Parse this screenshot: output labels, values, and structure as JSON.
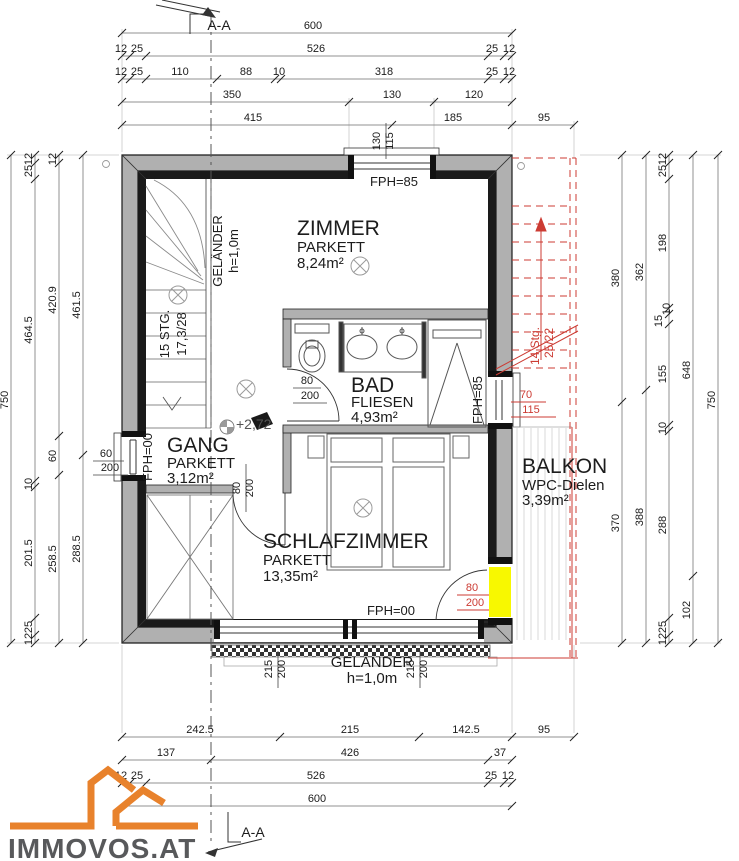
{
  "section": {
    "label": "A-A"
  },
  "logo": {
    "brand": "IMMOVOS.AT"
  },
  "colors": {
    "wall_gray": "#b0b0b0",
    "line_black": "#1a1a1a",
    "red": "#cc3b33",
    "yellow": "#f8f800",
    "logo_orange": "#e8822c",
    "logo_text": "#58595b"
  },
  "rooms": {
    "zimmer": {
      "name": "ZIMMER",
      "floor": "PARKETT",
      "area": "8,24m²"
    },
    "bad": {
      "name": "BAD",
      "floor": "FLIESEN",
      "area": "4,93m²"
    },
    "gang": {
      "name": "GANG",
      "floor": "PARKETT",
      "area": "3,12m²"
    },
    "schlafzimmer": {
      "name": "SCHLAFZIMMER",
      "floor": "PARKETT",
      "area": "13,35m²"
    },
    "balkon": {
      "name": "BALKON",
      "floor": "WPC-Dielen",
      "area": "3,39m²"
    }
  },
  "labels": {
    "fph85": "FPH=85",
    "fph00": "FPH=00",
    "gelaender_line1": "GELÄNDER",
    "gelaender_line2": "h=1,0m",
    "stairs_line1": "15 STG.",
    "stairs_line2": "17,3/28",
    "red_stairs_line1": "14 Stg.",
    "red_stairs_line2": "25/22",
    "level": "+2,72",
    "win_top_w": "130",
    "win_top_h": "115",
    "win_left_w": "60",
    "win_left_h": "200",
    "win_right_w": "70",
    "win_right_h": "115",
    "door_w": "80",
    "door_h": "200",
    "win_bottom_w": "215",
    "win_bottom_h": "200"
  },
  "dims": {
    "top_row1": [
      "600"
    ],
    "top_row2": [
      "12",
      "25",
      "526",
      "25",
      "12"
    ],
    "top_row3": [
      "12",
      "25",
      "110",
      "88",
      "10",
      "318",
      "25",
      "12"
    ],
    "top_row4": [
      "350",
      "130",
      "120"
    ],
    "top_row5": [
      "415",
      "185",
      "95"
    ],
    "bottom_row1": [
      "242.5",
      "215",
      "142.5",
      "95"
    ],
    "bottom_row2": [
      "137",
      "426",
      "37"
    ],
    "bottom_row3": [
      "12",
      "25",
      "526",
      "25",
      "12"
    ],
    "bottom_row4": [
      "600"
    ],
    "left_col1": [
      "750"
    ],
    "left_col2": [
      "12",
      "25",
      "464.5",
      "10",
      "201.5",
      "25",
      "12"
    ],
    "left_col3": [
      "12",
      "420.9",
      "60",
      "258.5"
    ],
    "left_col4": [
      "461.5",
      "288.5"
    ],
    "right_col1": [
      "380",
      "370"
    ],
    "right_col2": [
      "362",
      "388"
    ],
    "right_col3": [
      "12",
      "25",
      "198",
      "10",
      "15",
      "155",
      "10",
      "288",
      "25",
      "12"
    ],
    "right_col4": [
      "648",
      "102"
    ],
    "right_col5": [
      "750"
    ]
  }
}
